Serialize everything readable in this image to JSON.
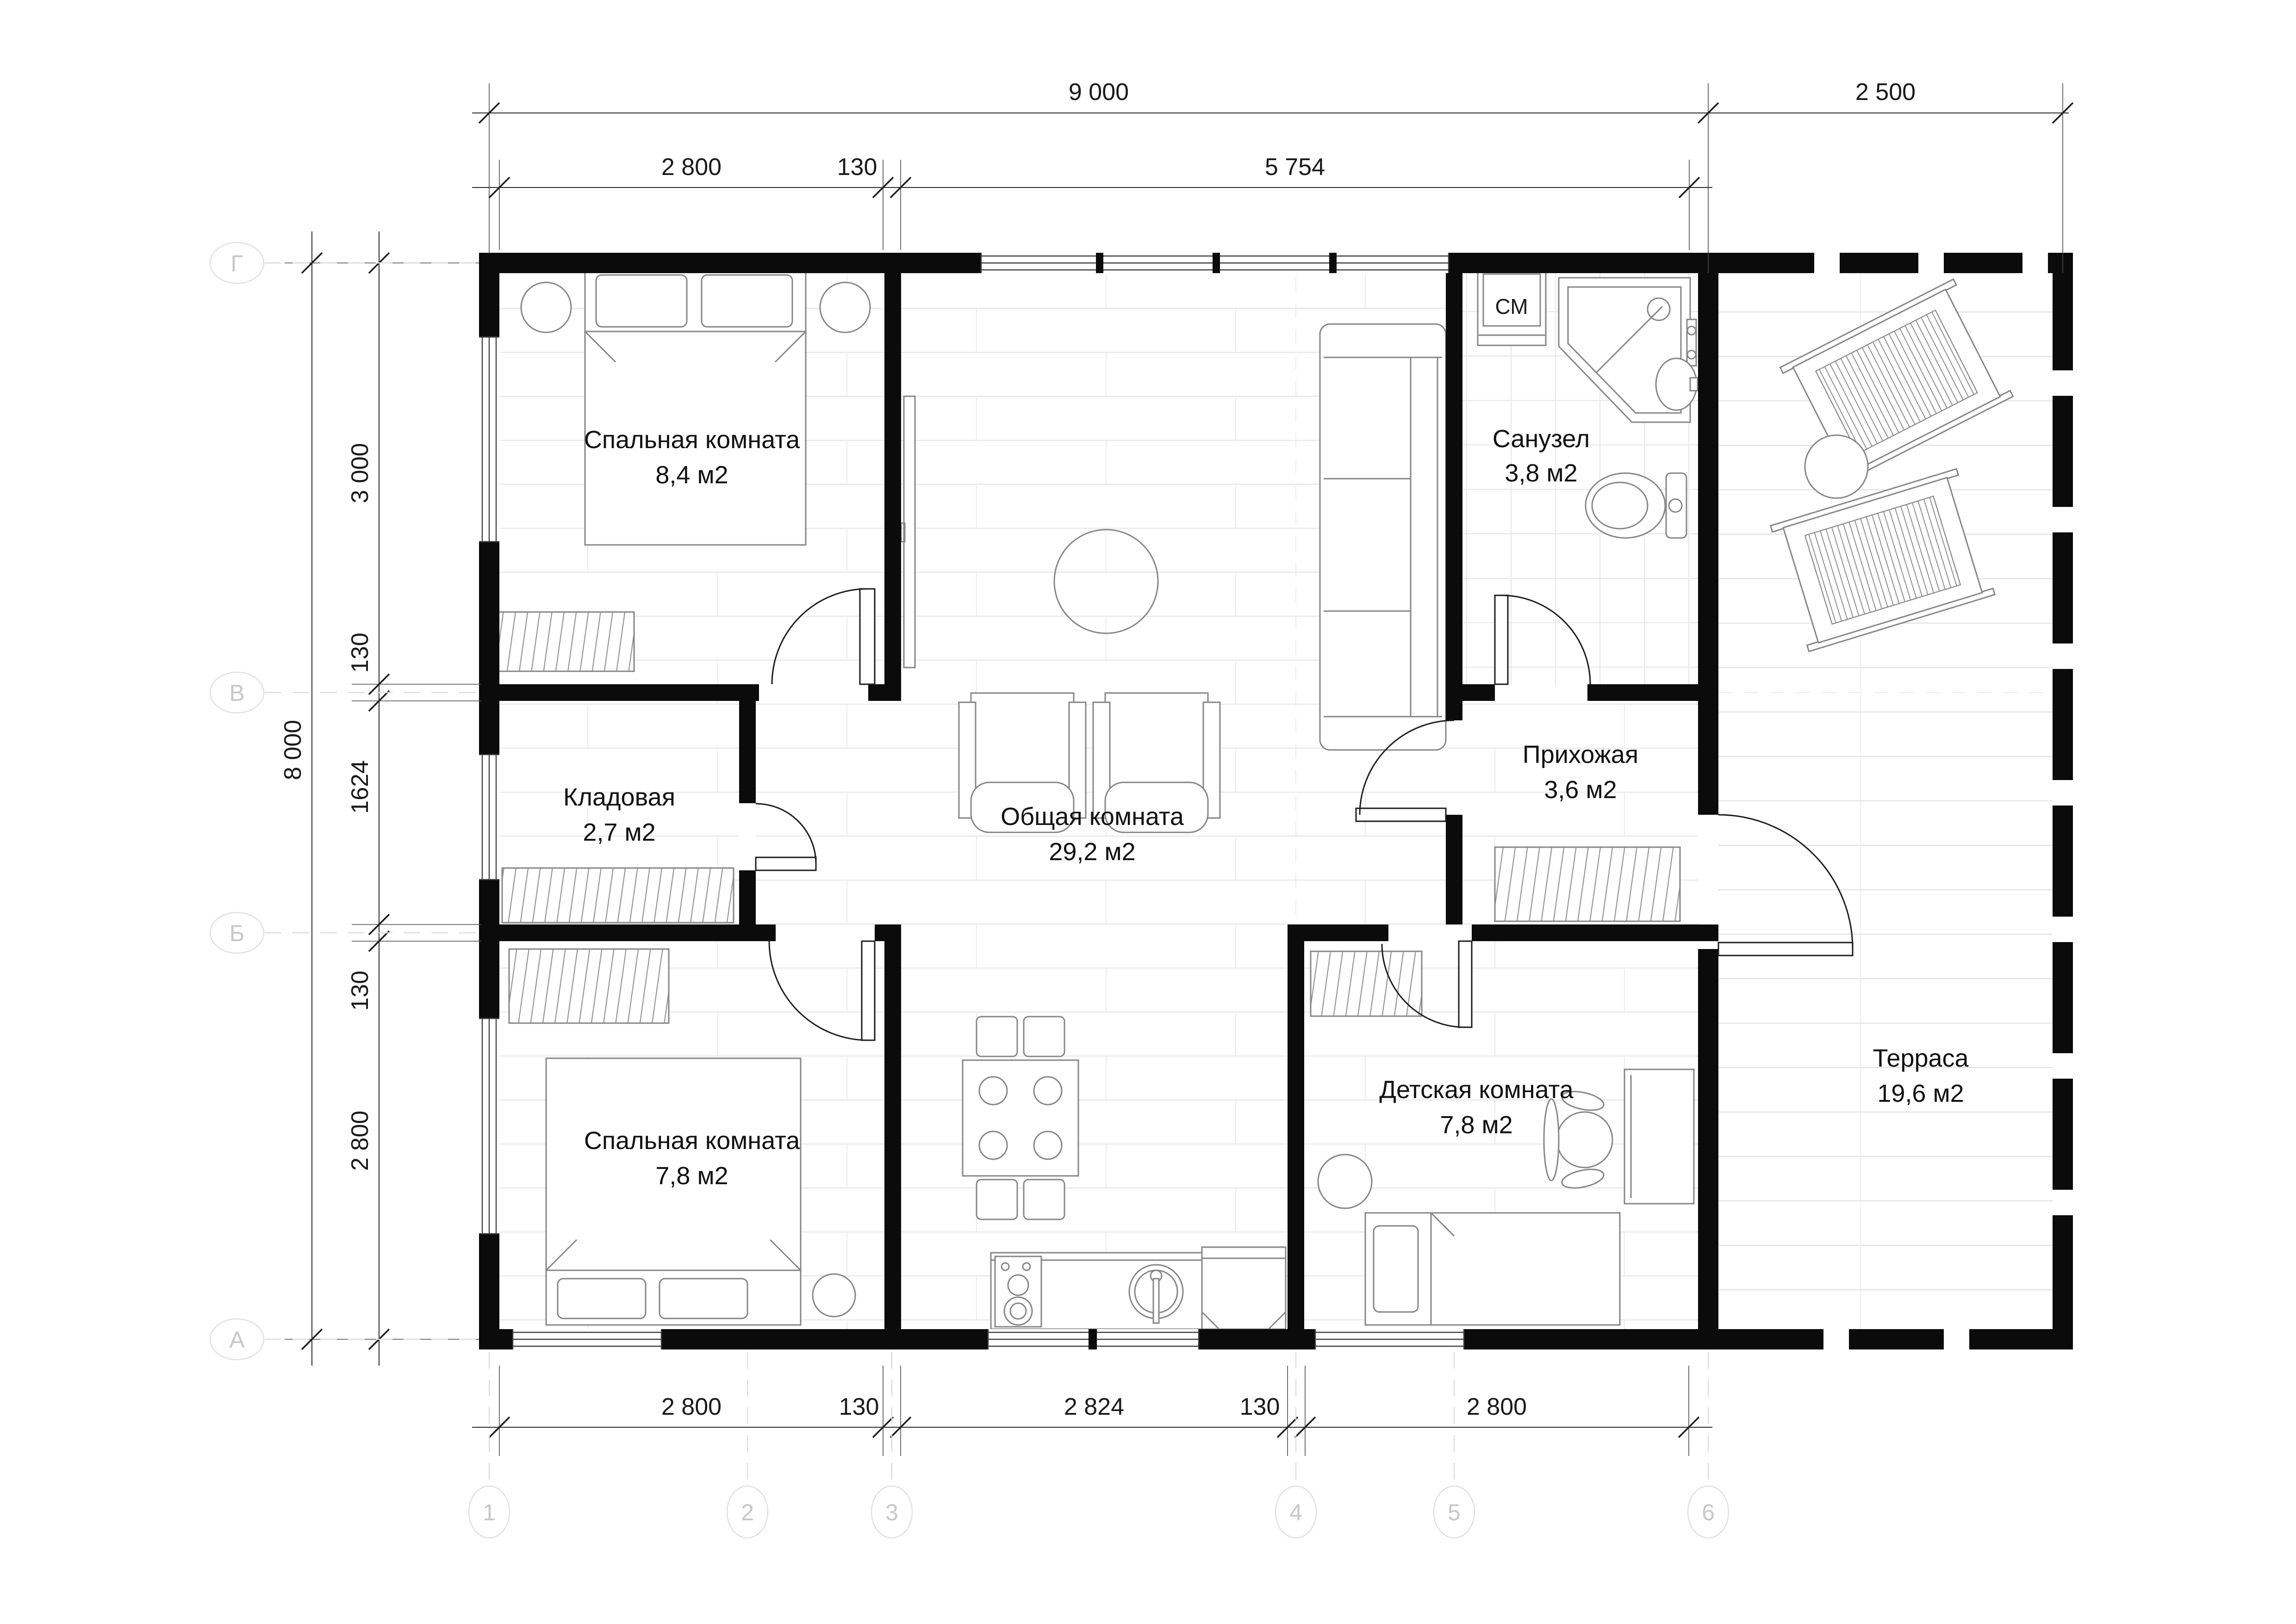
{
  "rooms": [
    {
      "name": "Спальная комната",
      "area": "8,4 м2"
    },
    {
      "name": "Кладовая",
      "area": "2,7 м2"
    },
    {
      "name": "Спальная комната",
      "area": "7,8 м2"
    },
    {
      "name": "Общая комната",
      "area": "29,2 м2"
    },
    {
      "name": "Санузел",
      "area": "3,8 м2"
    },
    {
      "name": "Прихожая",
      "area": "3,6 м2"
    },
    {
      "name": "Детская комната",
      "area": "7,8 м2"
    },
    {
      "name": "Терраса",
      "area": "19,6 м2"
    }
  ],
  "appliances": {
    "washing_machine_label": "СМ"
  },
  "dimensions": {
    "top_row1": [
      "9 000",
      "2 500"
    ],
    "top_row2": [
      "2 800",
      "130",
      "5 754"
    ],
    "bottom_row": [
      "2 800",
      "130",
      "2 824",
      "130",
      "2 800"
    ],
    "left_outer": [
      "8 000"
    ],
    "left_inner": [
      "3 000",
      "130",
      "1624",
      "130",
      "2 800"
    ]
  },
  "axes": {
    "rows": [
      "Г",
      "В",
      "Б",
      "А"
    ],
    "cols": [
      "1",
      "2",
      "3",
      "4",
      "5",
      "6"
    ]
  },
  "colors": {
    "wall": "#0b0b0b",
    "furniture_stroke": "#868686",
    "dimension_text": "#1a1a1a",
    "axis_bubble_text": "#c7c7c7",
    "floor_line": "#e8e8e8"
  }
}
